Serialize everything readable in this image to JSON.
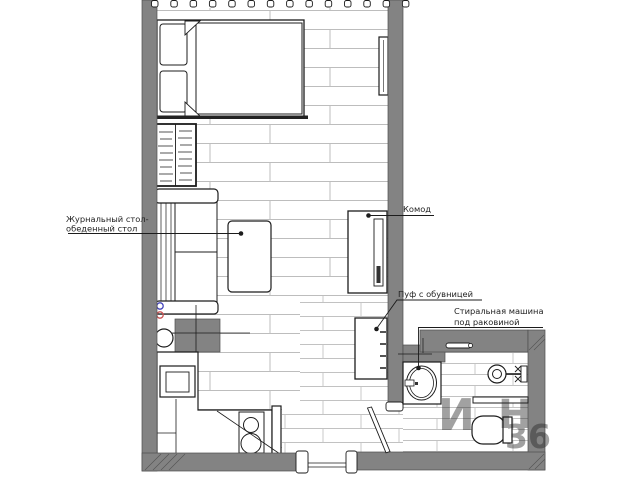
{
  "labels": {
    "coffee_dining_table": {
      "line1": "Журнальный стол-",
      "line2": "обеденный стол"
    },
    "dresser": "Комод",
    "pouf": "Пуф с обувницей",
    "washer": {
      "line1": "Стиральная машина",
      "line2": "под раковиной"
    }
  },
  "watermark": {
    "frag1": "И",
    "frag2": "Н",
    "frag3": "36"
  },
  "colors": {
    "wall": "#838383",
    "floor_line": "#bdbdbd",
    "outline": "#1c1c1c",
    "cold_water": "#4444bb",
    "hot_water": "#cc5555",
    "watermark": "#8f8f8f",
    "background": "#ffffff",
    "label": "#222222"
  }
}
